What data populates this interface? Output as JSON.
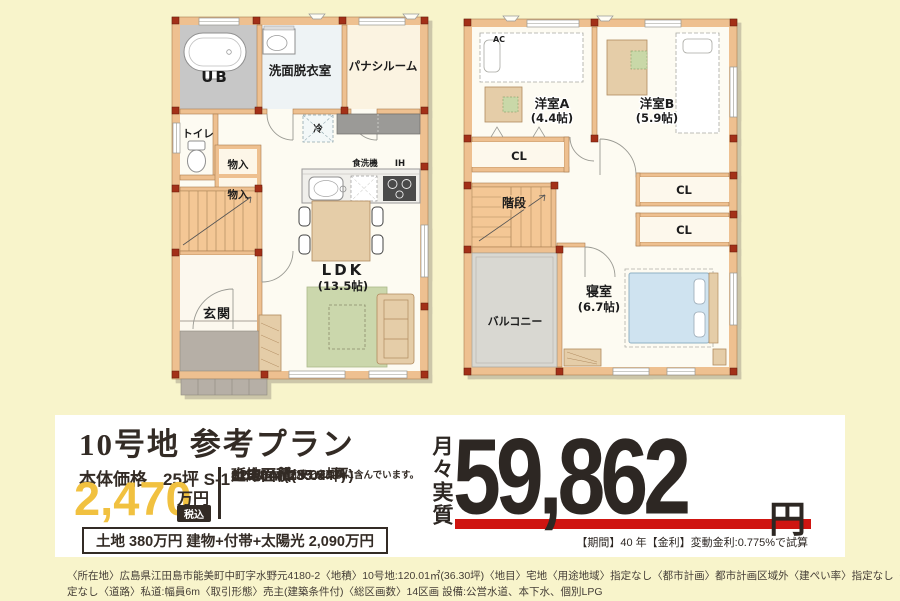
{
  "page": {
    "background": "#f8f4cb",
    "accent_yellow": "#f1c140",
    "accent_red": "#cf1511",
    "text_dark": "#2d2723"
  },
  "plan1f": {
    "labels": {
      "ub": "UB",
      "washroom": "洗面脱衣室",
      "pana_room": "パナシルーム",
      "toilet": "トイレ",
      "storage_a": "物入",
      "storage_b": "物入",
      "fridge": "冷",
      "dishwasher": "食洗機",
      "ih": "IH",
      "ldk": "LDK",
      "ldk_size": "(13.5帖)",
      "entrance": "玄関"
    }
  },
  "plan2f": {
    "labels": {
      "ac": "AC",
      "room_a": "洋室A",
      "room_a_size": "(4.4帖)",
      "room_b": "洋室B",
      "room_b_size": "(5.9帖)",
      "closet_a": "CL",
      "stairs": "階段",
      "closet_b": "CL",
      "closet_c": "CL",
      "bedroom": "寝室",
      "bedroom_size": "(6.7帖)",
      "balcony": "バルコニー"
    }
  },
  "panel": {
    "title": "10号地 参考プラン",
    "price_label": "本体価格",
    "price_plan": "25坪 S-1",
    "price_value": "2,470",
    "price_unit": "万円",
    "tax_badge": "税込",
    "land_area_label": "土地面積",
    "land_area_value": "118.84㎡(35.94坪)",
    "floor_area_label": "延床面積",
    "floor_area_value": "82.80㎡(25.04坪)",
    "area_note": "※バルコニー面積を床面積に含んでいます。",
    "breakdown": "土地 380万円  建物+付帯+太陽光 2,090万円",
    "monthly_label": "月々実質",
    "monthly_value": "59,862",
    "monthly_unit": "円",
    "loan_note": "【期間】40 年【金利】変動金利:0.775%で試算"
  },
  "footnote": {
    "line1": "〈所在地〉広島県江田島市能美町中町字水野元4180-2〈地積〉10号地:120.01㎡(36.30坪)〈地目〉宅地〈用途地域〉指定なし〈都市計画〉都市計画区域外〈建ぺい率〉指定なし〈容積率〉 指",
    "line2": "定なし〈道路〉私道:幅員6m〈取引形態〉売主(建築条件付)〈総区画数〉14区画 設備:公営水道、本下水、個別LPG"
  }
}
